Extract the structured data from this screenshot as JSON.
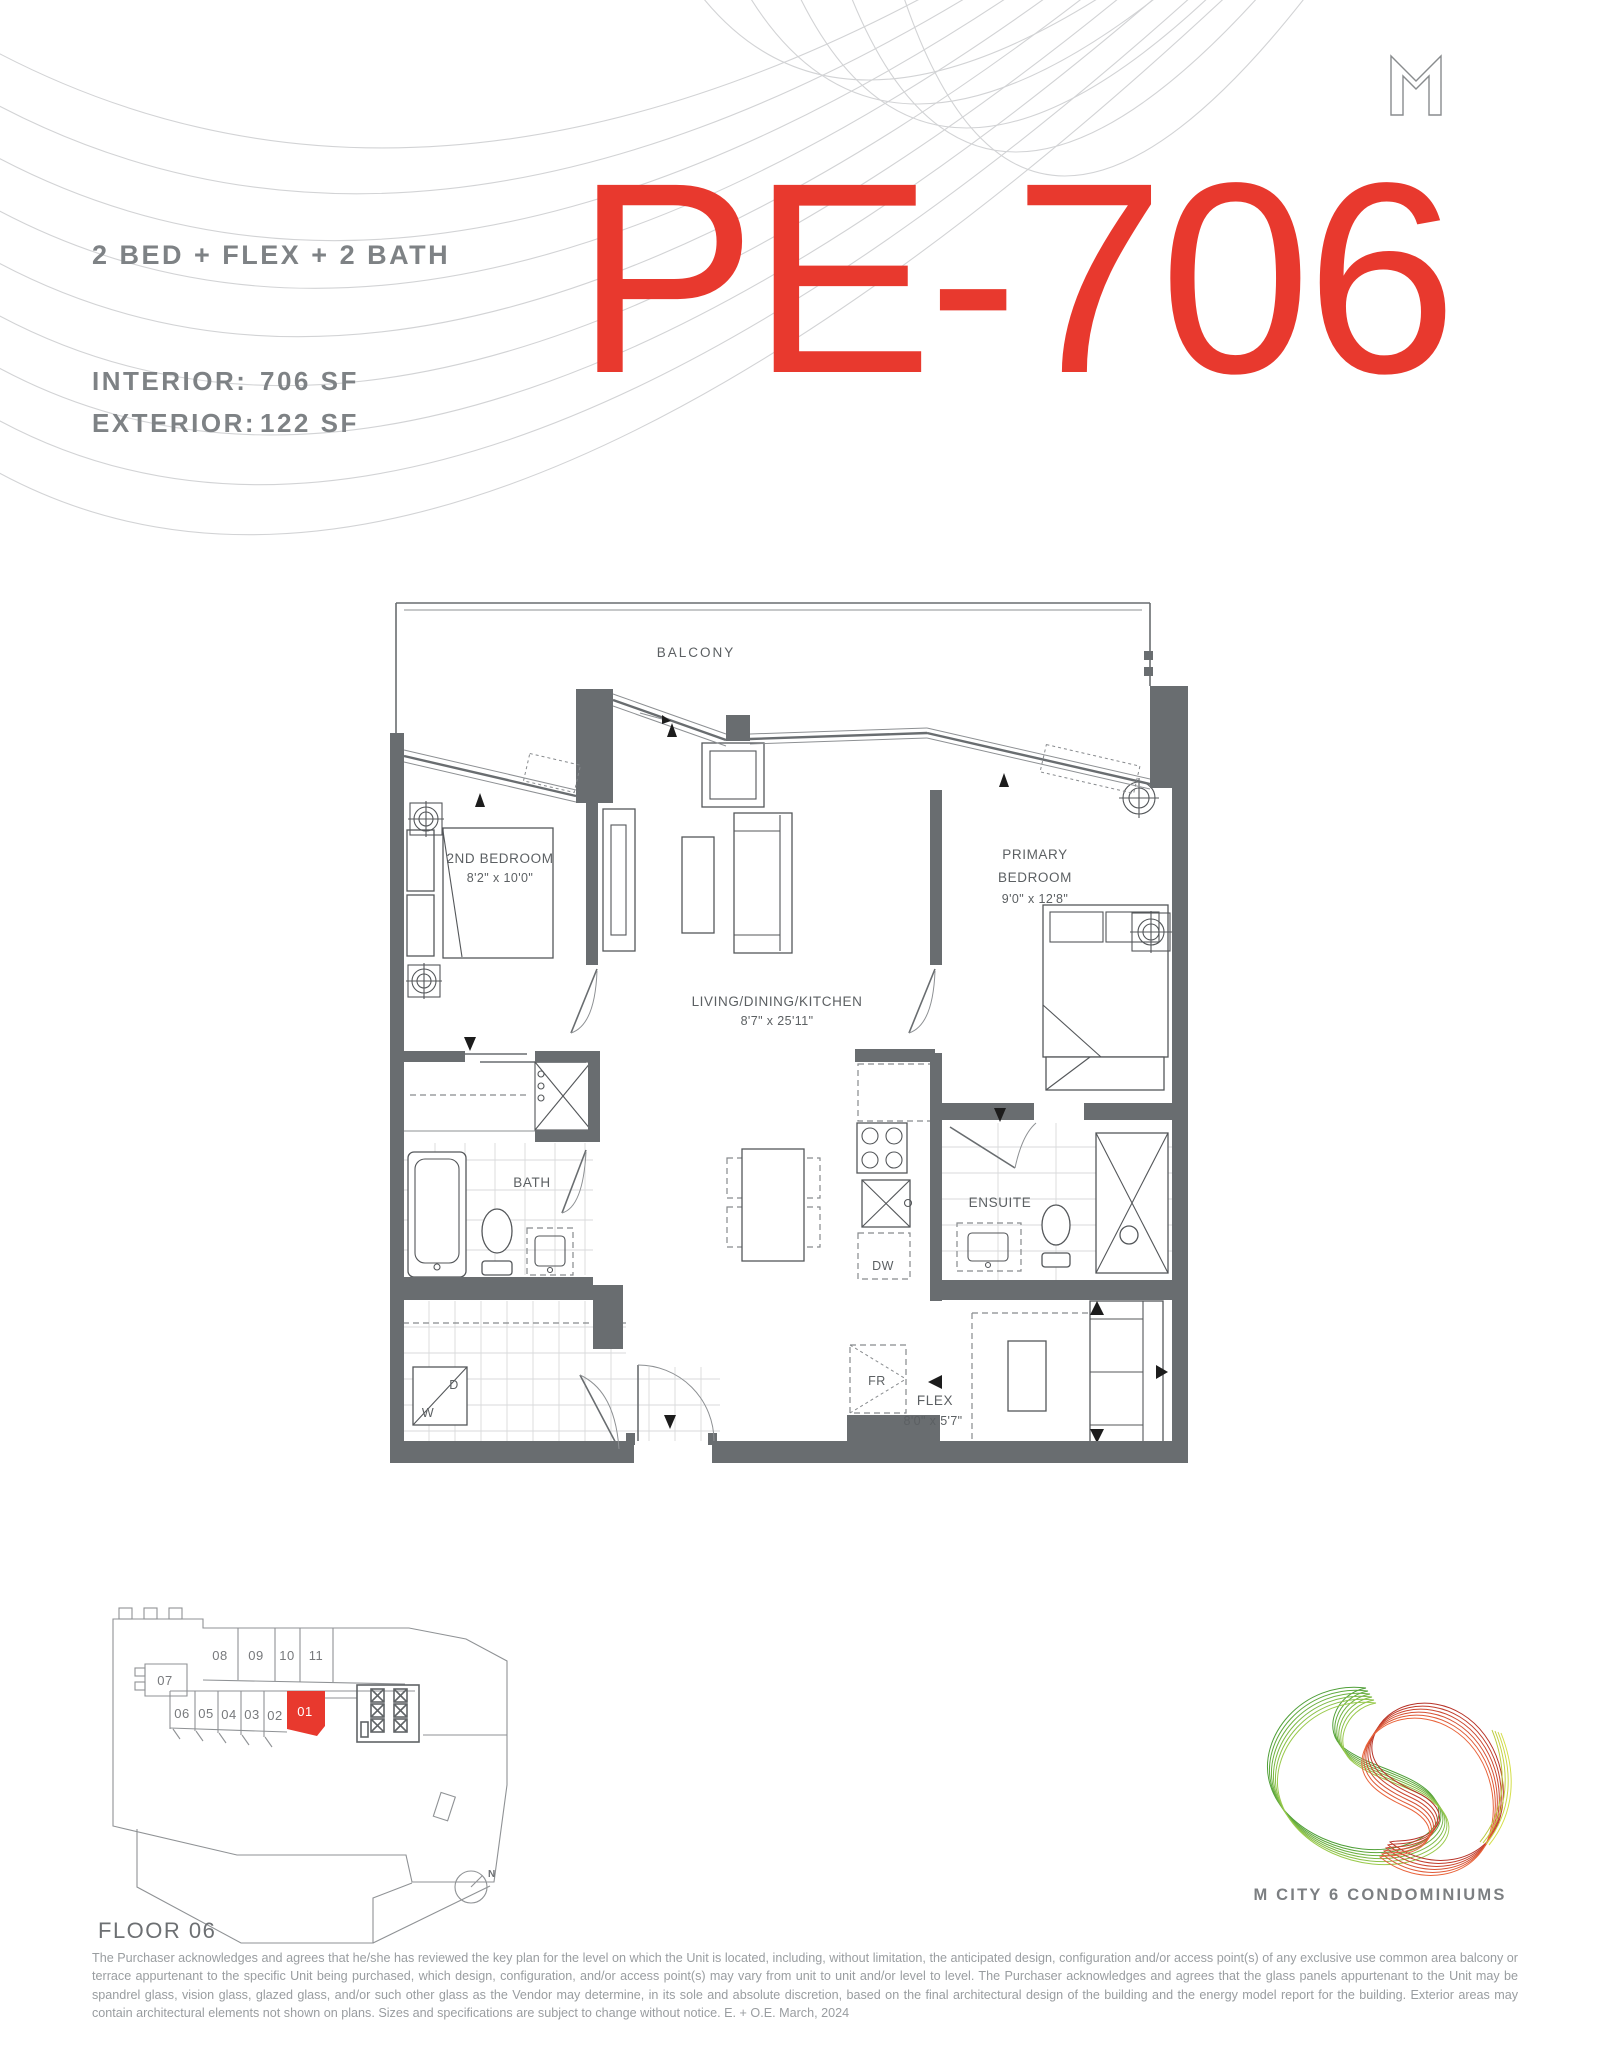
{
  "header": {
    "unit_type": "2 BED + FLEX + 2 BATH",
    "interior_label": "INTERIOR:",
    "interior_value": "706 SF",
    "exterior_label": "EXTERIOR:",
    "exterior_value": "122 SF",
    "unit_number": "PE-706",
    "accent_color": "#e8392e"
  },
  "floor_plan": {
    "balcony": "BALCONY",
    "second_bedroom": {
      "name": "2ND BEDROOM",
      "dims": "8'2\" x 10'0\""
    },
    "primary_bedroom": {
      "line1": "PRIMARY",
      "line2": "BEDROOM",
      "dims": "9'0\" x 12'8\""
    },
    "living": {
      "name": "LIVING/DINING/KITCHEN",
      "dims": "8'7\" x 25'11\""
    },
    "bath": "BATH",
    "ensuite": "ENSUITE",
    "flex": {
      "name": "FLEX",
      "dims": "8'0\" x 5'7\""
    },
    "appliances": {
      "dishwasher": "DW",
      "fridge": "FR",
      "dryer": "D",
      "washer": "W"
    }
  },
  "key_plan": {
    "floor_label": "FLOOR 06",
    "units_top": [
      "08",
      "09",
      "10",
      "11"
    ],
    "unit_left": "07",
    "units_bottom": [
      "06",
      "05",
      "04",
      "03",
      "02"
    ],
    "highlighted_unit": "01",
    "highlight_color": "#e8392e",
    "compass": "N"
  },
  "branding": {
    "logo_letter": "M",
    "project_name": "M CITY 6 CONDOMINIUMS"
  },
  "disclaimer": "The Purchaser acknowledges and agrees that he/she has reviewed the key plan for the level on which the Unit is located, including, without limitation, the anticipated design, configuration and/or access point(s) of any exclusive use common area balcony or terrace appurtenant to the specific Unit being purchased, which design, configuration, and/or access point(s) may vary from unit to unit and/or level to level. The Purchaser acknowledges and agrees that the glass panels appurtenant to the Unit may be spandrel glass, vision glass, glazed glass, and/or such other glass as the Vendor may determine, in its sole and absolute discretion, based on the final architectural design of the building and the energy model report for the building. Exterior areas may contain architectural elements not shown on plans. Sizes and specifications are subject to change without notice. E. + O.E. March, 2024"
}
